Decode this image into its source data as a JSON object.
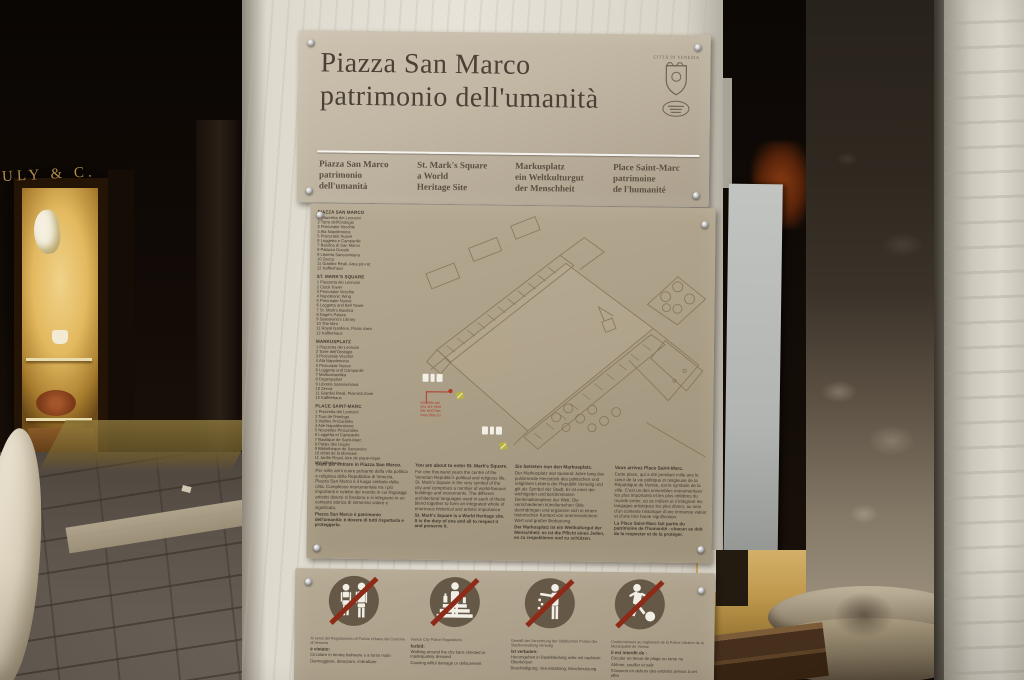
{
  "surroundings": {
    "shop_sign": "ULY & C.",
    "elements": {
      "left": "dark arcade with illuminated glass-shop window",
      "right": "two weathered marble columns with stone base and steps"
    }
  },
  "sign": {
    "title": {
      "line1": "Piazza San Marco",
      "line2": "patrimonio dell'umanità"
    },
    "crest": {
      "text": "CITTÀ DI VENEZIA",
      "icon": "venice-crest-icon"
    },
    "subtitles": [
      {
        "lines": [
          "Piazza San Marco",
          "patrimonio",
          "dell'umanità"
        ]
      },
      {
        "lines": [
          "St. Mark's Square",
          "a World",
          "Heritage Site"
        ]
      },
      {
        "lines": [
          "Markusplatz",
          "ein Weltkulturgut",
          "der Menschheit"
        ]
      },
      {
        "lines": [
          "Place Saint-Marc",
          "patrimoine",
          "de l'humanité"
        ]
      }
    ],
    "lists": [
      {
        "heading": "PIAZZA SAN MARCO",
        "items": [
          "1 Piazzetta dei Leoncini",
          "2 Torre dell'Orologio",
          "3 Procuratie Vecchie",
          "4 Ala Napoleonica",
          "5 Procuratie Nuove",
          "6 Loggetta e Campanile",
          "7 Basilica di San Marco",
          "8 Palazzo Ducale",
          "9 Libreria Sansoviniana",
          "10 Zecca",
          "11 Giardini Reali, Area pic-nic",
          "12 Kaffeehaus"
        ]
      },
      {
        "heading": "ST. MARK'S SQUARE",
        "items": [
          "1 Piazzetta dei Leoncini",
          "2 Clock Tower",
          "3 Procuratie Vecchie",
          "4 Napoleonic Wing",
          "5 Procuratie Nuove",
          "6 Loggetta and Bell Tower",
          "7 St. Mark's Basilica",
          "8 Doge's Palace",
          "9 Sansovino's Library",
          "10 The Mint",
          "11 Royal Gardens, Picnic Area",
          "12 Kaffeehaus"
        ]
      },
      {
        "heading": "MARKUSPLATZ",
        "items": [
          "1 Piazzetta dei Leoncini",
          "2 Torre dell'Orologio",
          "3 Procuratie Vecchie",
          "4 Ala Napoleonica",
          "5 Procuratie Nuove",
          "6 Loggetta und Campanile",
          "7 Markusbasilika",
          "8 Dogenpalast",
          "9 Libreria Sansoviniana",
          "10 Zecca",
          "11 Giardini Reali, Picknick-Zone",
          "12 Kaffeehaus"
        ]
      },
      {
        "heading": "PLACE SAINT-MARC",
        "items": [
          "1 Piazzetta dei Leoncini",
          "2 Tour de l'Horloge",
          "3 Vieilles Procuraties",
          "4 Aile Napoléonienne",
          "5 Nouvelles Procuraties",
          "6 Loggetta et Campanile",
          "7 Basilique de Saint-Marc",
          "8 Palais des Doges",
          "9 Bibliothèque de Sansovino",
          "10 Hôtel de la Monnaie",
          "11 Jardin Royal, Aire de pique-nique",
          "12 Kaffeehaus"
        ]
      }
    ],
    "map": {
      "you_are_here_lines": [
        "voi siete qui",
        "you are here",
        "Sie sind hier",
        "vous êtes ici"
      ],
      "marker_icons": [
        "toilets-pictogram-marker",
        "info-yellow-marker"
      ]
    },
    "paragraphs": [
      {
        "intro": "State per entrare in Piazza San Marco.",
        "body": "Per mille anni cuore pulsante della vita politica e religiosa della Repubblica di Venezia, Piazza San Marco è il luogo simbolo della città. Complesso monumentale tra i più importanti e celebri del mondo in cui linguaggi artistici diversi si fondono e si integrano in un contesto storico di immenso valore e significato.",
        "bold": "Piazza San Marco è patrimonio dell'umanità: è dovere di tutti rispettarla e proteggerla."
      },
      {
        "intro": "You are about to enter St. Mark's Square.",
        "body": "For one thousand years the centre of the Venetian Republic's political and religious life, St. Mark's Square is the very symbol of the city and comprises a number of world-famous buildings and monuments. The different architectural languages used in each of these blend together to form an integrated whole of enormous historical and artistic importance.",
        "bold": "St. Mark's Square is a World Heritage site. It is the duty of one and all to respect it and preserve it."
      },
      {
        "intro": "Sie betreten nun den Markusplatz.",
        "body": "Der Markusplatz war tausend Jahre lang das pulsierende Herzstück des politischen und religiösen Lebens der Republik Venedig und gilt als Symbol der Stadt. Er ist einer der wichtigsten und berühmtesten Denkmalkomplexe der Welt. Die verschiedenen künstlerischen Stile durchdringen und ergänzen sich in einem historischen Kontext von unermesslichem Wert und großer Bedeutung.",
        "bold": "Der Markusplatz ist ein Weltkulturgut der Menschheit: es ist die Pflicht eines Jeden, es zu respektieren und zu schützen."
      },
      {
        "intro": "Vous arrivez Place Saint-Marc.",
        "body": "Cette place, qui a été pendant mille ans le cœur de la vie politique et religieuse de la République de Venise, est le symbole de la ville. C'est un des ensembles monumentaux les plus importants et les plus célèbres du monde entier, où se mêlent et s'intègrent les langages artistiques les plus divers, au sein d'un contexte historique d'une immense valeur et d'une très haute signification.",
        "bold": "La Place Saint-Marc fait partie du patrimoine de l'humanité : chacun se doit de la respecter et de la protéger."
      }
    ],
    "rules": [
      {
        "icon": "no-swimwear-icon",
        "note": "Ai sensi del Regolamento di Polizia Urbana del Comune di Venezia",
        "heading": "è vietato:",
        "items": [
          "Circolare in tenuta balneare o a torso nudo",
          "Danneggiare, deturpare, imbrattare"
        ]
      },
      {
        "icon": "no-picnic-on-steps-icon",
        "note": "Venice City Police Regulations",
        "heading": "forbid:",
        "items": [
          "Walking around the city bare-chested or inadequately dressed",
          "Causing wilful damage or defacement"
        ]
      },
      {
        "icon": "no-littering-icon",
        "note": "Gemäß der Verordnung der Städtischen Polizei der Stadtverwaltung Venedig",
        "heading": "ist verboten:",
        "items": [
          "Herumgehen in Badekleidung oder mit nacktem Oberkörper",
          "Beschädigung, Verunstaltung, Beschmutzung"
        ]
      },
      {
        "icon": "no-ball-games-icon",
        "note": "Conformément au règlement de la Police Urbaine de la Municipalité de Venise",
        "heading": "il est interdit de :",
        "items": [
          "Circuler en tenue de plage ou torse nu",
          "Abîmer, souiller et salir",
          "S'asseoir en dehors des endroits prévus à cet effet"
        ]
      }
    ]
  },
  "colors": {
    "plate": "#b5a992",
    "plate_header": "#c6bba9",
    "sign_text": "#3f382e",
    "prohibition_circle": "#655846",
    "prohibition_slash": "#8e2a18",
    "pictogram": "#f1eee6",
    "shop_gold": "#b08a4e",
    "shop_glow": "#e3b95f",
    "you_are_here_red": "#b03a2a",
    "map_line": "#7d6c52"
  }
}
